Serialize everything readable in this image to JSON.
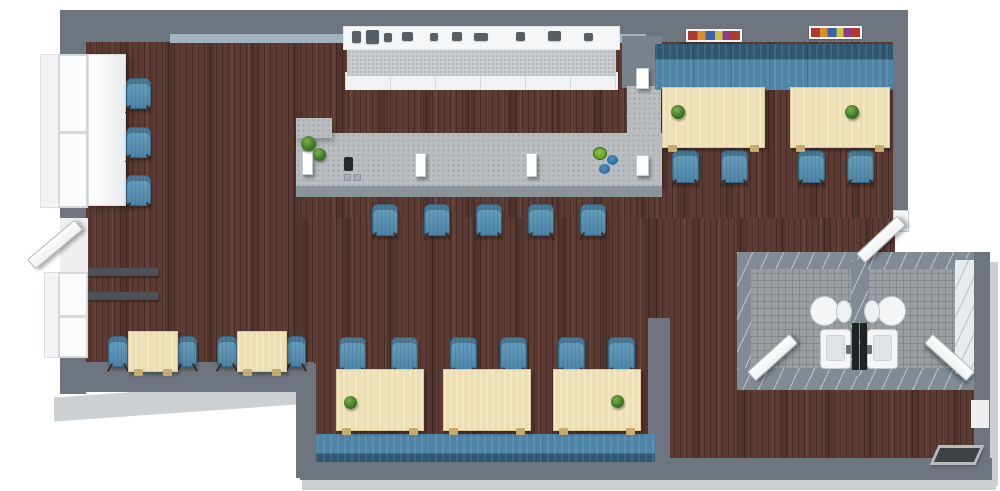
{
  "scene": {
    "name": "restaurant-cafe-3d-floor-plan",
    "canvas": {
      "width": 1000,
      "height": 491
    },
    "background": "#ffffff",
    "areas": [
      "main-dining",
      "bar",
      "window-seating",
      "booth-dining",
      "restrooms",
      "entry-corridor"
    ]
  },
  "palette": {
    "wall": "#6e757e",
    "wall_inner_face": "#a2b4c2",
    "wall_shadow": "#cdd0d3",
    "wood_floor": "#5e3b32",
    "tile_floor": "#9a9ea1",
    "counter": "#babec1",
    "table": "#eddfb2",
    "chair": "#5d92b2",
    "banquette_dark": "#2e5770",
    "banquette_light": "#4e84a6",
    "fixture_white": "#f3f5f6",
    "plant_green": "#4e8a2d",
    "doormat": "#3d4247"
  },
  "inventory": {
    "large_dining_tables": 5,
    "small_cafe_tables": 2,
    "dining_chairs": 14,
    "bar_stools": 5,
    "window_armchairs": 3,
    "banquette_benches": 2,
    "restrooms": 2,
    "toilets": 2,
    "sinks": 2,
    "doors": 5,
    "windows": 2,
    "wall_art_frames": 2,
    "plants": 6
  },
  "elements": [
    {
      "type": "shadow",
      "name": "wall-shadow-right",
      "x": 986,
      "y": 262,
      "w": 12,
      "h": 224
    },
    {
      "type": "shadow",
      "name": "wall-shadow-bottom",
      "x": 302,
      "y": 476,
      "w": 694,
      "h": 14
    },
    {
      "type": "shadow",
      "name": "wall-shadow-bottom-left",
      "x": 54,
      "y": 388,
      "w": 272,
      "h": 24,
      "cls": "skew"
    },
    {
      "type": "floor-wood",
      "name": "floor-main",
      "x": 78,
      "y": 32,
      "w": 817,
      "h": 186
    },
    {
      "type": "floor-wood",
      "name": "floor-left-dining",
      "x": 78,
      "y": 218,
      "w": 222,
      "h": 150
    },
    {
      "type": "floor-wood",
      "name": "floor-center-dining",
      "x": 300,
      "y": 218,
      "w": 350,
      "h": 244
    },
    {
      "type": "floor-wood",
      "name": "floor-right-strip",
      "x": 650,
      "y": 218,
      "w": 245,
      "h": 38
    },
    {
      "type": "floor-wood",
      "name": "floor-corridor",
      "x": 650,
      "y": 256,
      "w": 88,
      "h": 206
    },
    {
      "type": "floor-wood",
      "name": "floor-back-corridor",
      "x": 738,
      "y": 386,
      "w": 237,
      "h": 76
    },
    {
      "type": "wall",
      "name": "wall-top",
      "x": 60,
      "y": 10,
      "w": 848,
      "h": 32
    },
    {
      "type": "wall-inner",
      "name": "wall-top-inner-face",
      "x": 170,
      "y": 34,
      "w": 476,
      "h": 9
    },
    {
      "type": "wall",
      "name": "wall-left",
      "x": 60,
      "y": 10,
      "w": 26,
      "h": 384
    },
    {
      "type": "wall",
      "name": "wall-right",
      "x": 893,
      "y": 10,
      "w": 15,
      "h": 202
    },
    {
      "type": "wall",
      "name": "wall-bottom-left",
      "x": 60,
      "y": 362,
      "w": 254,
      "h": 30
    },
    {
      "type": "wall",
      "name": "wall-step",
      "x": 296,
      "y": 364,
      "w": 20,
      "h": 114
    },
    {
      "type": "wall",
      "name": "wall-bottom",
      "x": 300,
      "y": 458,
      "w": 692,
      "h": 22
    },
    {
      "type": "wall",
      "name": "wall-center-divider",
      "x": 648,
      "y": 318,
      "w": 22,
      "h": 146
    },
    {
      "type": "tile",
      "name": "restroom-left-floor",
      "x": 750,
      "y": 266,
      "w": 101,
      "h": 106
    },
    {
      "type": "tile",
      "name": "restroom-right-floor",
      "x": 868,
      "y": 266,
      "w": 90,
      "h": 106
    },
    {
      "type": "wall-rr",
      "name": "restroom-wall-top",
      "x": 737,
      "y": 252,
      "w": 253,
      "h": 17
    },
    {
      "type": "wall-rr",
      "name": "restroom-wall-left",
      "x": 737,
      "y": 252,
      "w": 14,
      "h": 138
    },
    {
      "type": "wall-rr",
      "name": "restroom-wall-bottom",
      "x": 737,
      "y": 368,
      "w": 238,
      "h": 22
    },
    {
      "type": "wall-rr",
      "name": "restroom-wall-divider",
      "x": 851,
      "y": 260,
      "w": 17,
      "h": 116
    },
    {
      "type": "dark-strip",
      "name": "restroom-mirror-panel",
      "x": 852,
      "y": 323,
      "w": 7,
      "h": 47
    },
    {
      "type": "dark-strip",
      "name": "restroom-mirror-panel",
      "x": 860,
      "y": 323,
      "w": 7,
      "h": 47
    },
    {
      "type": "wall-white",
      "name": "restroom-wall-right-inner",
      "x": 955,
      "y": 260,
      "w": 21,
      "h": 114
    },
    {
      "type": "wall",
      "name": "wall-right-lower",
      "x": 974,
      "y": 252,
      "w": 16,
      "h": 216
    },
    {
      "type": "door-niche",
      "name": "side-door-opening",
      "x": 971,
      "y": 400,
      "w": 18,
      "h": 28
    },
    {
      "type": "window-bay",
      "name": "window-bay-upper",
      "x": 40,
      "y": 54,
      "w": 26,
      "h": 154
    },
    {
      "type": "window-bay",
      "name": "window-bay-lower",
      "x": 44,
      "y": 272,
      "w": 22,
      "h": 86
    },
    {
      "type": "window",
      "name": "left-window-upper",
      "x": 58,
      "y": 54,
      "w": 30,
      "h": 154
    },
    {
      "type": "door-niche",
      "name": "left-door-opening",
      "x": 60,
      "y": 218,
      "w": 28,
      "h": 58
    },
    {
      "type": "window",
      "name": "left-window-lower",
      "x": 58,
      "y": 272,
      "w": 30,
      "h": 86
    },
    {
      "type": "ledge",
      "name": "wall-ledge",
      "x": 88,
      "y": 268,
      "w": 70,
      "h": 8
    },
    {
      "type": "ledge",
      "name": "wall-ledge",
      "x": 88,
      "y": 292,
      "w": 70,
      "h": 8
    },
    {
      "type": "window-counter",
      "name": "window-counter",
      "x": 88,
      "y": 54,
      "w": 38,
      "h": 152
    },
    {
      "type": "chair",
      "name": "window-armchair",
      "x": 126,
      "y": 78,
      "w": 25,
      "h": 31
    },
    {
      "type": "chair",
      "name": "window-armchair",
      "x": 126,
      "y": 127,
      "w": 25,
      "h": 31
    },
    {
      "type": "chair",
      "name": "window-armchair",
      "x": 126,
      "y": 175,
      "w": 25,
      "h": 31
    },
    {
      "type": "backbar-cab",
      "name": "backbar-cabinets",
      "x": 345,
      "y": 72,
      "w": 273,
      "h": 18
    },
    {
      "type": "backbar-mid",
      "name": "backbar-counter",
      "x": 347,
      "y": 46,
      "w": 269,
      "h": 30
    },
    {
      "type": "backbar-top",
      "name": "backbar-worktop",
      "x": 343,
      "y": 26,
      "w": 277,
      "h": 24
    },
    {
      "type": "appliance",
      "name": "coffee-machine",
      "x": 352,
      "y": 31,
      "w": 9,
      "h": 12
    },
    {
      "type": "appliance",
      "name": "coffee-machine",
      "x": 366,
      "y": 30,
      "w": 13,
      "h": 14
    },
    {
      "type": "appliance",
      "name": "bar-appliance",
      "x": 384,
      "y": 33,
      "w": 8,
      "h": 9
    },
    {
      "type": "appliance",
      "name": "bar-appliance",
      "x": 402,
      "y": 32,
      "w": 11,
      "h": 9
    },
    {
      "type": "appliance",
      "name": "bar-appliance",
      "x": 430,
      "y": 33,
      "w": 8,
      "h": 8
    },
    {
      "type": "appliance",
      "name": "bar-appliance",
      "x": 452,
      "y": 32,
      "w": 10,
      "h": 9
    },
    {
      "type": "appliance",
      "name": "bar-appliance",
      "x": 474,
      "y": 33,
      "w": 14,
      "h": 8
    },
    {
      "type": "appliance",
      "name": "bar-appliance",
      "x": 516,
      "y": 32,
      "w": 9,
      "h": 9
    },
    {
      "type": "appliance",
      "name": "bar-appliance",
      "x": 548,
      "y": 31,
      "w": 13,
      "h": 10
    },
    {
      "type": "appliance",
      "name": "bar-appliance",
      "x": 584,
      "y": 33,
      "w": 9,
      "h": 8
    },
    {
      "type": "pillar",
      "name": "bar-wall-pillar",
      "x": 622,
      "y": 36,
      "w": 40,
      "h": 52
    },
    {
      "type": "counter",
      "name": "bar-counter-return",
      "x": 627,
      "y": 86,
      "w": 34,
      "h": 102
    },
    {
      "type": "counter",
      "name": "bar-counter",
      "x": 296,
      "y": 133,
      "w": 366,
      "h": 53
    },
    {
      "type": "counter",
      "name": "bar-counter-corner",
      "x": 296,
      "y": 118,
      "w": 36,
      "h": 20
    },
    {
      "type": "counter-front",
      "name": "bar-counter-front",
      "x": 296,
      "y": 186,
      "w": 366,
      "h": 11
    },
    {
      "type": "stand",
      "name": "menu-stand",
      "x": 302,
      "y": 151,
      "w": 11,
      "h": 24
    },
    {
      "type": "stand",
      "name": "menu-stand",
      "x": 415,
      "y": 153,
      "w": 11,
      "h": 24
    },
    {
      "type": "stand",
      "name": "menu-stand",
      "x": 526,
      "y": 153,
      "w": 11,
      "h": 24
    },
    {
      "type": "stand",
      "name": "menu-stand",
      "x": 636,
      "y": 68,
      "w": 13,
      "h": 21
    },
    {
      "type": "stand",
      "name": "menu-stand",
      "x": 636,
      "y": 155,
      "w": 13,
      "h": 21
    },
    {
      "type": "plant",
      "name": "bar-plant",
      "x": 301,
      "y": 136,
      "w": 15,
      "h": 15
    },
    {
      "type": "plant",
      "name": "bar-plant",
      "x": 313,
      "y": 148,
      "w": 13,
      "h": 13
    },
    {
      "type": "register",
      "name": "cash-register",
      "x": 344,
      "y": 157,
      "w": 9,
      "h": 14
    },
    {
      "type": "small-gray",
      "name": "bar-item",
      "x": 344,
      "y": 174,
      "w": 7,
      "h": 7
    },
    {
      "type": "small-gray",
      "name": "bar-item",
      "x": 354,
      "y": 174,
      "w": 7,
      "h": 7
    },
    {
      "type": "bowl-green",
      "name": "decor-bowl",
      "x": 593,
      "y": 147,
      "w": 14,
      "h": 13
    },
    {
      "type": "bowl-blue",
      "name": "decor-bowl",
      "x": 607,
      "y": 155,
      "w": 11,
      "h": 10
    },
    {
      "type": "bowl-blue",
      "name": "decor-bowl",
      "x": 599,
      "y": 164,
      "w": 11,
      "h": 10
    },
    {
      "type": "stool",
      "name": "bar-stool",
      "x": 372,
      "y": 204,
      "w": 26,
      "h": 32
    },
    {
      "type": "stool",
      "name": "bar-stool",
      "x": 424,
      "y": 204,
      "w": 26,
      "h": 32
    },
    {
      "type": "stool",
      "name": "bar-stool",
      "x": 476,
      "y": 204,
      "w": 26,
      "h": 32
    },
    {
      "type": "stool",
      "name": "bar-stool",
      "x": 528,
      "y": 204,
      "w": 26,
      "h": 32
    },
    {
      "type": "stool",
      "name": "bar-stool",
      "x": 580,
      "y": 204,
      "w": 26,
      "h": 32
    },
    {
      "type": "banquette",
      "name": "banquette-upper",
      "x": 655,
      "y": 44,
      "w": 238,
      "h": 46
    },
    {
      "type": "art",
      "name": "wall-art",
      "x": 686,
      "y": 29,
      "w": 56,
      "h": 13
    },
    {
      "type": "art",
      "name": "wall-art",
      "x": 809,
      "y": 26,
      "w": 53,
      "h": 13
    },
    {
      "type": "chair",
      "name": "dining-chair",
      "x": 672,
      "y": 150,
      "w": 27,
      "h": 33
    },
    {
      "type": "chair",
      "name": "dining-chair",
      "x": 721,
      "y": 150,
      "w": 27,
      "h": 33
    },
    {
      "type": "chair",
      "name": "dining-chair",
      "x": 798,
      "y": 150,
      "w": 27,
      "h": 33
    },
    {
      "type": "chair",
      "name": "dining-chair",
      "x": 847,
      "y": 150,
      "w": 27,
      "h": 33
    },
    {
      "type": "table",
      "name": "dining-table",
      "x": 662,
      "y": 87,
      "w": 103,
      "h": 61
    },
    {
      "type": "table",
      "name": "dining-table",
      "x": 790,
      "y": 87,
      "w": 100,
      "h": 61
    },
    {
      "type": "plant",
      "name": "table-plant",
      "x": 671,
      "y": 105,
      "w": 14,
      "h": 14
    },
    {
      "type": "plant",
      "name": "table-plant",
      "x": 845,
      "y": 105,
      "w": 14,
      "h": 14
    },
    {
      "type": "chair",
      "name": "dining-chair",
      "x": 108,
      "y": 336,
      "w": 20,
      "h": 31
    },
    {
      "type": "chair",
      "name": "dining-chair",
      "x": 177,
      "y": 336,
      "w": 20,
      "h": 31
    },
    {
      "type": "chair",
      "name": "dining-chair",
      "x": 217,
      "y": 336,
      "w": 20,
      "h": 31
    },
    {
      "type": "chair",
      "name": "dining-chair",
      "x": 286,
      "y": 336,
      "w": 20,
      "h": 31
    },
    {
      "type": "table",
      "name": "cafe-table",
      "x": 128,
      "y": 331,
      "w": 50,
      "h": 41
    },
    {
      "type": "table",
      "name": "cafe-table",
      "x": 237,
      "y": 331,
      "w": 50,
      "h": 41
    },
    {
      "type": "banquette",
      "name": "banquette-lower",
      "x": 316,
      "y": 434,
      "w": 339,
      "h": 28,
      "cls": "flip"
    },
    {
      "type": "chair",
      "name": "dining-chair",
      "x": 339,
      "y": 337,
      "w": 27,
      "h": 34
    },
    {
      "type": "chair",
      "name": "dining-chair",
      "x": 391,
      "y": 337,
      "w": 27,
      "h": 34
    },
    {
      "type": "chair",
      "name": "dining-chair",
      "x": 450,
      "y": 337,
      "w": 27,
      "h": 34
    },
    {
      "type": "chair",
      "name": "dining-chair",
      "x": 500,
      "y": 337,
      "w": 27,
      "h": 34
    },
    {
      "type": "chair",
      "name": "dining-chair",
      "x": 558,
      "y": 337,
      "w": 27,
      "h": 34
    },
    {
      "type": "chair",
      "name": "dining-chair",
      "x": 608,
      "y": 337,
      "w": 27,
      "h": 34
    },
    {
      "type": "table",
      "name": "dining-table",
      "x": 336,
      "y": 369,
      "w": 88,
      "h": 62
    },
    {
      "type": "table",
      "name": "dining-table",
      "x": 443,
      "y": 369,
      "w": 88,
      "h": 62
    },
    {
      "type": "table",
      "name": "dining-table",
      "x": 553,
      "y": 369,
      "w": 88,
      "h": 62
    },
    {
      "type": "plant",
      "name": "table-plant",
      "x": 344,
      "y": 396,
      "w": 13,
      "h": 13
    },
    {
      "type": "plant",
      "name": "table-plant",
      "x": 611,
      "y": 395,
      "w": 13,
      "h": 13
    },
    {
      "type": "toilet",
      "name": "toilet",
      "x": 810,
      "y": 295,
      "w": 42,
      "h": 30
    },
    {
      "type": "toilet",
      "name": "toilet",
      "x": 864,
      "y": 295,
      "w": 42,
      "h": 30,
      "cls": "flip"
    },
    {
      "type": "sink",
      "name": "sink",
      "x": 820,
      "y": 329,
      "w": 31,
      "h": 40
    },
    {
      "type": "sink",
      "name": "sink",
      "x": 867,
      "y": 329,
      "w": 31,
      "h": 40,
      "cls": "flip"
    },
    {
      "type": "door",
      "name": "restroom-left-door",
      "x": 744,
      "y": 351,
      "w": 57,
      "h": 13,
      "rot": -42
    },
    {
      "type": "door",
      "name": "restroom-right-door",
      "x": 921,
      "y": 351,
      "w": 57,
      "h": 13,
      "rot": 42
    },
    {
      "type": "jamb",
      "name": "door-jamb",
      "x": 893,
      "y": 210,
      "w": 16,
      "h": 22
    },
    {
      "type": "door",
      "name": "hall-door",
      "x": 853,
      "y": 233,
      "w": 56,
      "h": 13,
      "rot": -43
    },
    {
      "type": "door",
      "name": "entrance-door",
      "x": 24,
      "y": 238,
      "w": 62,
      "h": 13,
      "rot": -40
    },
    {
      "type": "mat",
      "name": "doormat",
      "x": 934,
      "y": 445,
      "w": 46,
      "h": 20
    }
  ]
}
